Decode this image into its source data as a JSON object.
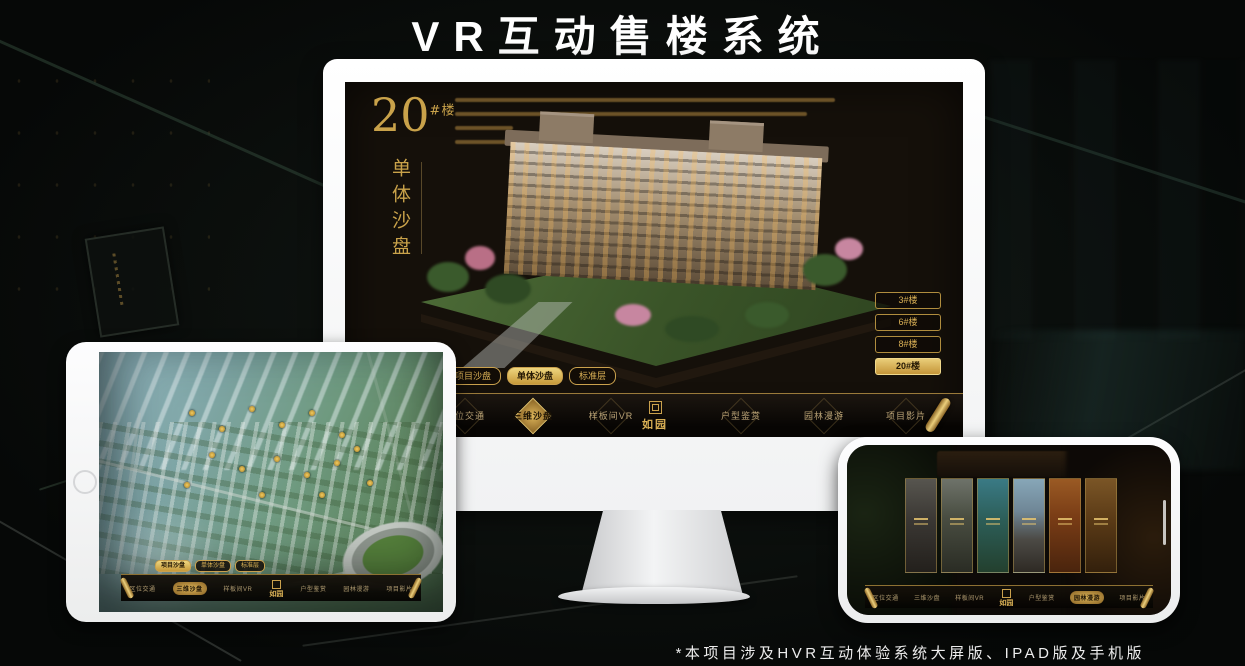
{
  "header": {
    "title": "VR互动售楼系统"
  },
  "footer": {
    "note": "*本项目涉及HVR互动体验系统大屏版、IPAD版及手机版"
  },
  "brand": {
    "logo_text": "如园"
  },
  "app": {
    "tabs": [
      {
        "label": "项目沙盘"
      },
      {
        "label": "单体沙盘"
      },
      {
        "label": "标准层"
      }
    ],
    "nav_items": [
      {
        "label": "区位交通"
      },
      {
        "label": "三维沙盘"
      },
      {
        "label": "样板间VR"
      },
      {
        "label": "户型鉴赏"
      },
      {
        "label": "园林漫游"
      },
      {
        "label": "项目影片"
      }
    ]
  },
  "monitor": {
    "device": "desktop-large-screen",
    "screen_title_no": "20",
    "screen_title_unit": "#楼",
    "screen_subtitle": "单体沙盘",
    "active_tab": "单体沙盘",
    "active_nav": "三维沙盘",
    "active_building": "20#楼",
    "building_buttons": [
      {
        "label": "3#楼"
      },
      {
        "label": "6#楼"
      },
      {
        "label": "8#楼"
      },
      {
        "label": "20#楼"
      }
    ]
  },
  "tablet": {
    "device": "ipad",
    "active_tab": "项目沙盘",
    "active_nav": "三维沙盘"
  },
  "phone": {
    "device": "mobile",
    "active_nav": "园林漫游",
    "panel_scenes": [
      "gate-entry",
      "living-room",
      "garden-tower",
      "residence-building",
      "autumn-courtyard",
      "display-wall"
    ]
  },
  "colors": {
    "gold": "#c9a24a",
    "gold_bright": "#e0b45a",
    "active_fill": "#d8ab4e",
    "screen_bg": "#15100a"
  }
}
